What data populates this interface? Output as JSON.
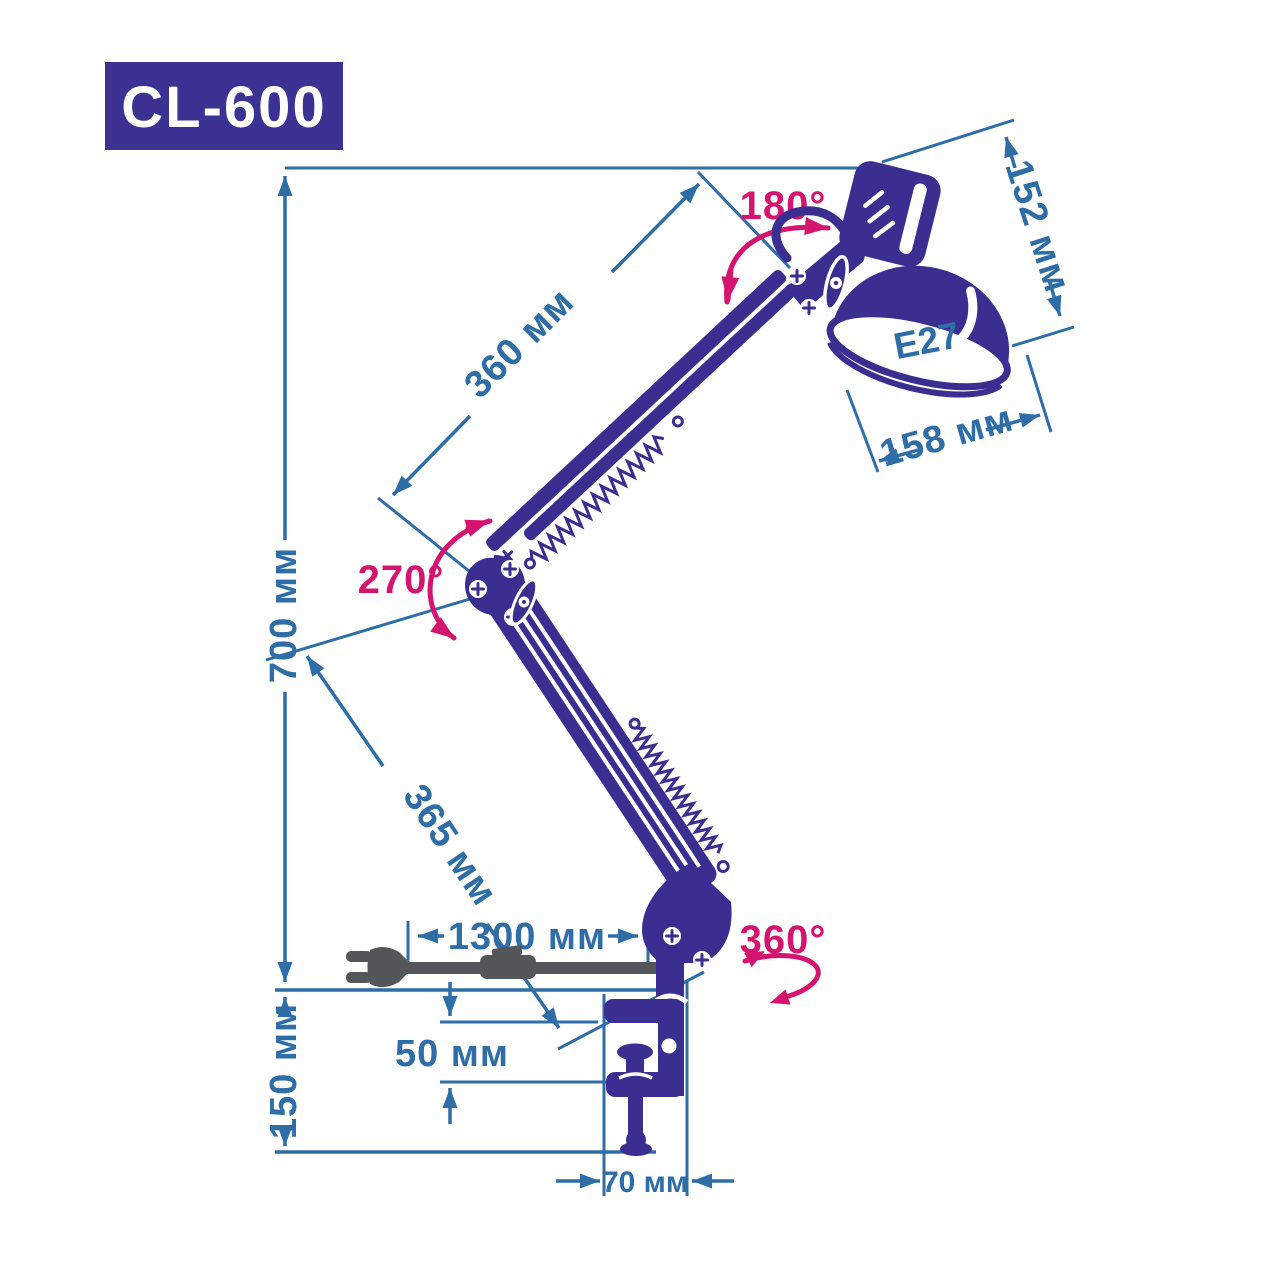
{
  "product": {
    "model_badge": "CL-600",
    "socket_label": "E27"
  },
  "dimensions": {
    "upper_arm_length": "360 мм",
    "shade_height": "152 мм",
    "shade_diameter": "158 мм",
    "overall_height": "700 мм",
    "lower_arm_length": "365 мм",
    "cord_length": "1300 мм",
    "clamp_opening": "50 мм",
    "mount_height": "150 мм",
    "clamp_width": "70 мм"
  },
  "angles": {
    "shade_rotation": "180°",
    "elbow_rotation": "270°",
    "base_rotation": "360°"
  },
  "colors": {
    "lamp": "#3b2e91",
    "dimension": "#2e6da6",
    "angle": "#d4146e",
    "cord": "#55565a",
    "badge_bg": "#3c3294",
    "badge_text": "#ffffff",
    "background": "#ffffff"
  }
}
